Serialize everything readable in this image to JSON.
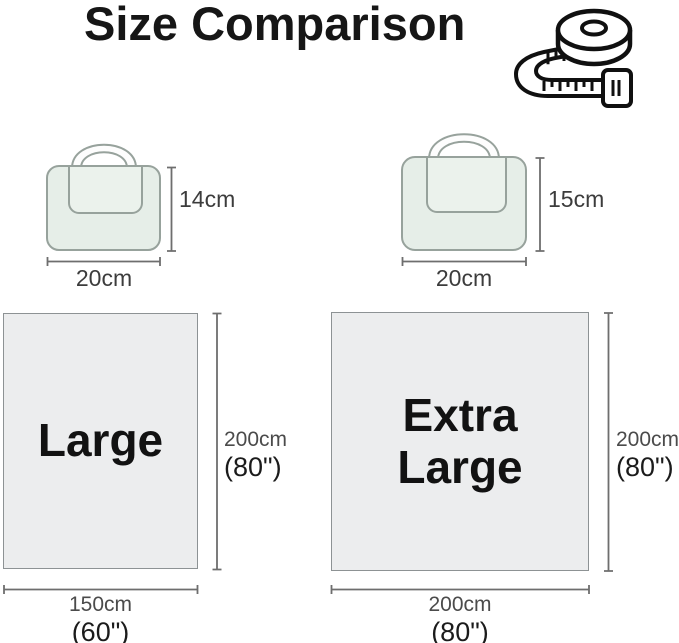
{
  "title": "Size Comparison",
  "header_icon": "tape-measure-icon",
  "pouches": [
    {
      "name": "pouch-small",
      "height": "14cm",
      "width": "20cm"
    },
    {
      "name": "pouch-large",
      "height": "15cm",
      "width": "20cm"
    }
  ],
  "blankets": [
    {
      "label": "Large",
      "height_cm": "200cm",
      "height_in": "(80\")",
      "width_cm": "150cm",
      "width_in": "(60\")"
    },
    {
      "label": "Extra Large",
      "height_cm": "200cm",
      "height_in": "(80\")",
      "width_cm": "200cm",
      "width_in": "(80\")"
    }
  ],
  "colors": {
    "background": "#ffffff",
    "title": "#161616",
    "bag_fill": "#e6eee8",
    "bag_flap_fill": "#ebf2ec",
    "bag_outline": "#97a29c",
    "panel_fill": "#ecedee",
    "panel_border": "#8d9294",
    "dimension_line": "#6e6e6e",
    "cm_label": "#4b4b4b",
    "inch_label": "#1b1b1b",
    "icon_stroke": "#101010"
  }
}
